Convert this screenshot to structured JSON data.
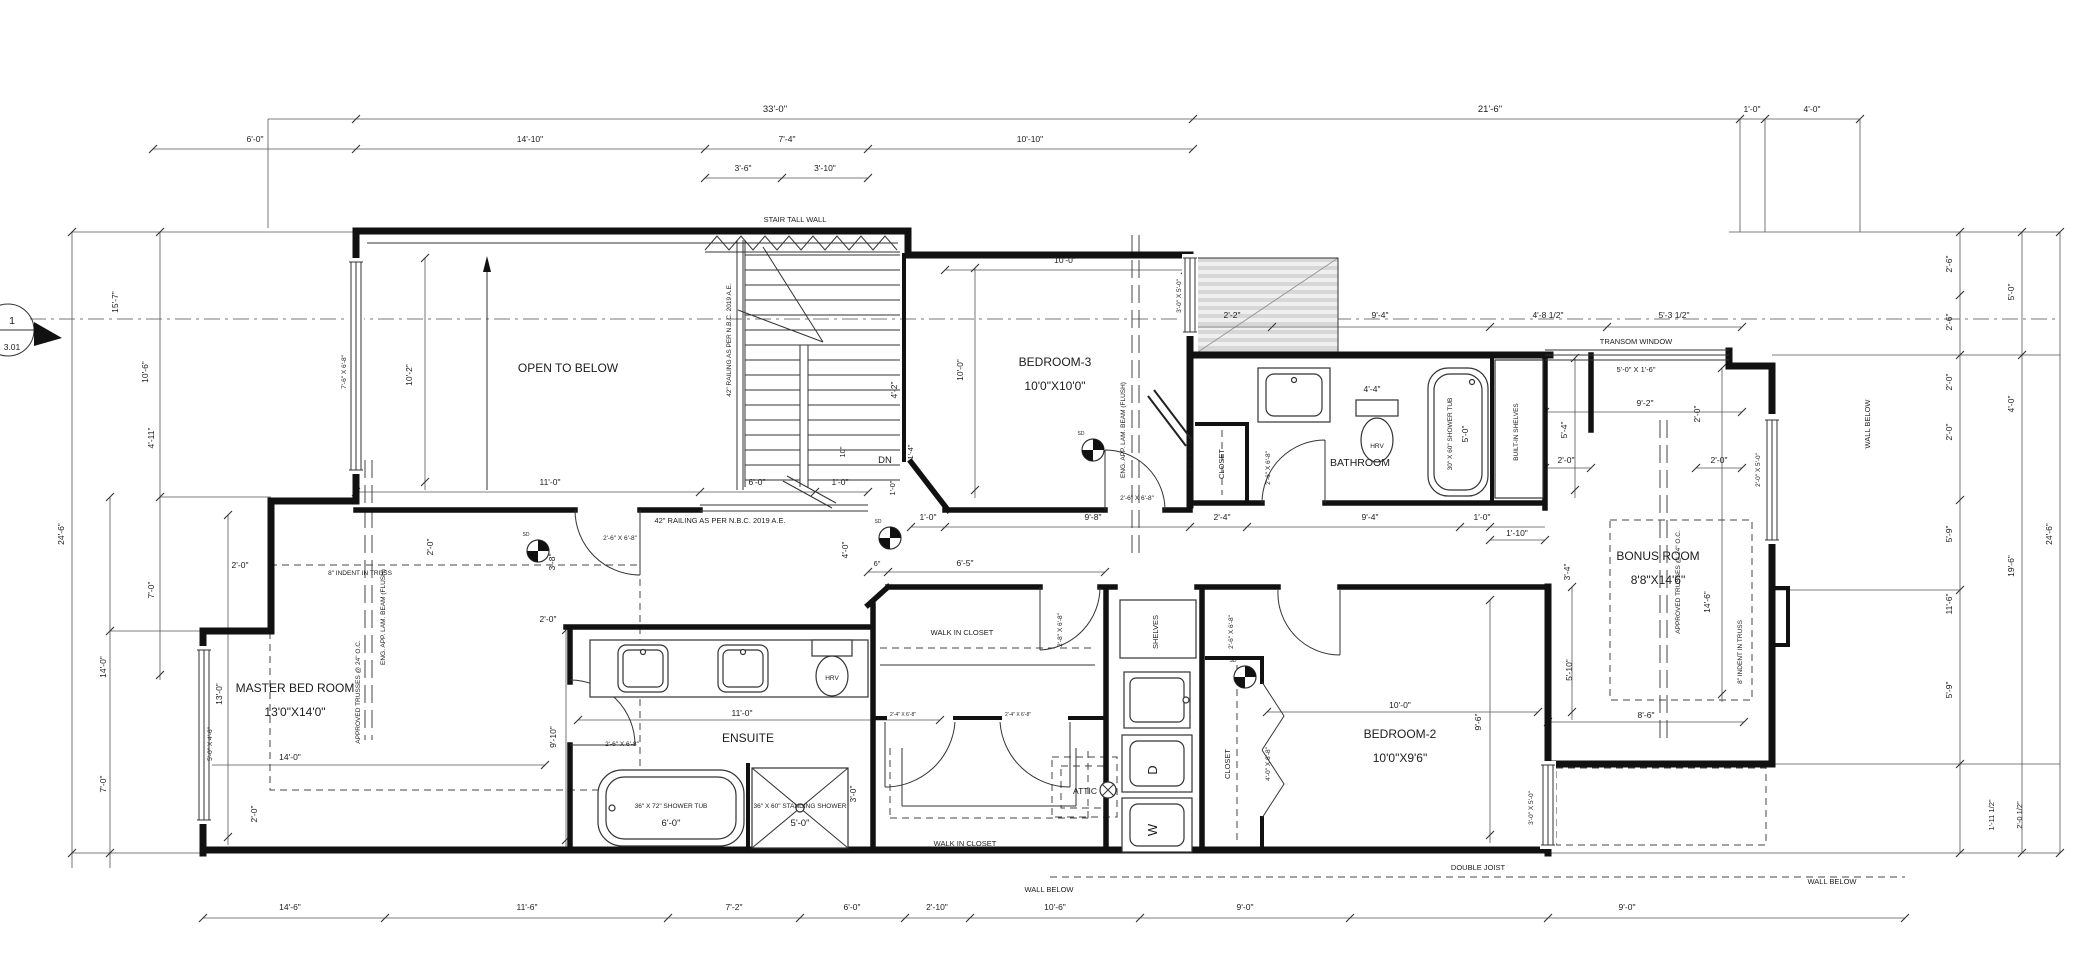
{
  "sheet_marker": {
    "number": "1",
    "detail": "3.01"
  },
  "rooms": {
    "open_to_below": "OPEN TO BELOW",
    "bedroom3": "BEDROOM-3",
    "bedroom3_size": "10'0\"X10'0\"",
    "bathroom": "BATHROOM",
    "bonus": "BONUS ROOM",
    "bonus_size": "8'8\"X14'6\"",
    "master": "MASTER BED ROOM",
    "master_size": "13'0\"X14'0\"",
    "ensuite": "ENSUITE",
    "wic_upper": "WALK IN CLOSET",
    "wic_lower": "WALK IN CLOSET",
    "attic": "ATTIC",
    "bedroom2": "BEDROOM-2",
    "bedroom2_size": "10'0\"X9'6\"",
    "closet_bed3": "CLOSET",
    "closet_bed2": "CLOSET",
    "shelves": "SHELVES",
    "builtin_shelves": "BUILT-IN SHELVES"
  },
  "fixtures": {
    "tub_bath": "30\" X 60\" SHOWER TUB",
    "tub_bath_size": "5'-0\"",
    "tub_ensuite": "36\" X 72\" SHOWER TUB",
    "tub_ensuite_size": "6'-0\"",
    "standing_shower": "36\" X 60\" STANDING SHOWER",
    "standing_shower_size": "5'-0\"",
    "hrv": "HRV",
    "dryer": "D",
    "washer": "W",
    "down": "DN",
    "sd": "SD"
  },
  "notes": {
    "stair_tall_wall": "STAIR TALL WALL",
    "transom": "TRANSOM WINDOW",
    "railing": "42\" RAILING AS PER N.B.C. 2019 A.E.",
    "beam": "ENG. APP. LAM. BEAM (FLUSH)",
    "trusses": "APPROVED TRUSSES @ 24\" O.C.",
    "indent": "8\" INDENT IN TRUSS",
    "wall_below": "WALL BELOW",
    "double_joist": "DOUBLE JOIST"
  },
  "openings": {
    "door2_6": "2'-6\" X 6'-8\"",
    "door2_4": "2'-4\" X 6'-8\"",
    "door2_8": "2'-8\" X 6'-8\"",
    "door4_0": "4'-0\" X 6'-8\"",
    "win3_0x5_0": "3'-0\" X 5'-0\"",
    "win2_0x5_0": "2'-0\" X 5'-0\"",
    "win7_6": "7'-6\" X 6'-8\"",
    "win5_0x4_6": "5'-0\" X 4'-6\"",
    "transom_size": "5'-0\" X 1'-6\""
  },
  "dims": {
    "d33_0": "33'-0\"",
    "d21_6": "21'-6\"",
    "d1_0": "1'-0\"",
    "d4_0": "4'-0\"",
    "d6_0": "6'-0\"",
    "d14_10": "14'-10\"",
    "d7_4": "7'-4\"",
    "d10_10": "10'-10\"",
    "d3_6": "3'-6\"",
    "d3_10": "3'-10\"",
    "d2_2": "2'-2\"",
    "d9_4": "9'-4\"",
    "d4_8h": "4'-8 1/2\"",
    "d5_3h": "5'-3 1/2\"",
    "d10_0": "10'-0\"",
    "d2_6": "2'-6\"",
    "d5_0": "5'-0\"",
    "d2_0": "2'-0\"",
    "d5_9": "5'-9\"",
    "d24_6": "24'-6\"",
    "d19_6": "19'-6\"",
    "d11_6": "11'-6\"",
    "d1_11h": "1'-11 1/2\"",
    "d2_0h": "2'-0 1/2\"",
    "d5_10": "5'-10\"",
    "d3_4": "3'-4\"",
    "d14_6": "14'-6\"",
    "d8_6": "8'-6\"",
    "d1_10": "1'-10\"",
    "d9_2": "9'-2\"",
    "d5_4": "5'-4\"",
    "d10_2": "10'-2\"",
    "d11_0": "11'-0\"",
    "d13_0": "13'-0\"",
    "d14_0": "14'-0\"",
    "d9_10": "9'-10\"",
    "d3_0": "3'-0\"",
    "d9_6": "9'-6\"",
    "d9_8": "9'-8\"",
    "d2_4": "2'-4\"",
    "d4_4": "4'-4\"",
    "din6": "6\"",
    "d6_5": "6'-5\"",
    "din10": "10\"",
    "d1_4": "1'-4\"",
    "d4_2": "4'-2\"",
    "d15_7": "15'-7\"",
    "d10_6": "10'-6\"",
    "d4_11": "4'-11\"",
    "d7_0": "7'-0\"",
    "d7_2": "7'-2\"",
    "d2_10": "2'-10\"",
    "d9_0": "9'-0\"",
    "d3_8": "3'-8\""
  }
}
